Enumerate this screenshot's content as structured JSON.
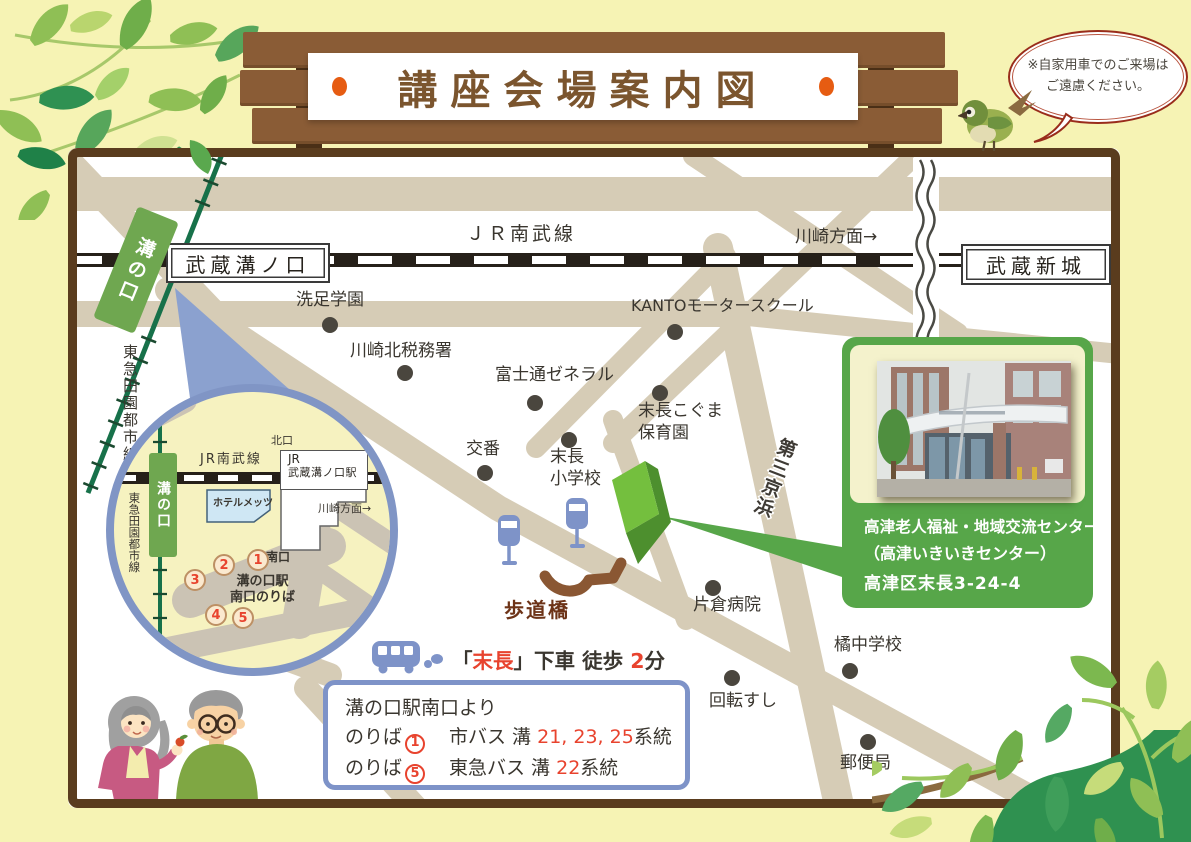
{
  "title": "講座会場案内図",
  "note": "※自家用車でのご来場は\nご遠慮ください。",
  "map": {
    "jr_line": "ＪＲ南武線",
    "direction": "川崎方面→",
    "station_left": "武蔵溝ノ口",
    "station_right": "武蔵新城",
    "tokyu_line": "東急田園都市線",
    "tokyu_station": "溝の口",
    "expressway": "第三京浜",
    "bridge": "歩道橋",
    "landmarks": [
      "洗足学園",
      "川崎北税務署",
      "富士通ゼネラル",
      "KANTOモータースクール",
      "末長こぐま\n保育園",
      "交番",
      "末長\n小学校",
      "片倉病院",
      "回転すし",
      "橘中学校",
      "郵便局"
    ]
  },
  "inset": {
    "jr_line": "JR南武線",
    "north_exit": "北口",
    "station_line1": "JR",
    "station_line2": "武蔵溝ノ口駅",
    "hotel": "ホテルメッツ",
    "direction": "川崎方面→",
    "south_exit": "南口",
    "stops_label": "溝の口駅\n南口のりば",
    "stops": [
      "1",
      "2",
      "3",
      "4",
      "5"
    ]
  },
  "destination": {
    "name": "高津老人福祉・地域交流センター",
    "sub_name": "（高津いきいきセンター）",
    "address": "高津区末長3-24-4"
  },
  "bus_stop": {
    "open": "「",
    "name": "末長",
    "after": "」下車 徒歩 ",
    "minutes": "2",
    "unit": "分"
  },
  "routes": {
    "heading": "溝の口駅南口より",
    "rows": [
      {
        "label": "のりば",
        "no": "1",
        "line": "市バス 溝 ",
        "numbers": "21, 23, 25",
        "suffix": "系統"
      },
      {
        "label": "のりば",
        "no": "5",
        "line": "東急バス 溝 ",
        "numbers": "22",
        "suffix": "系統"
      }
    ]
  },
  "colors": {
    "background": "#f6f3b4",
    "wood": "#8a5c36",
    "frame": "#5a3c1e",
    "title": "#7b552e",
    "accent_orange": "#e65c12",
    "accent_red": "#e8432e",
    "road": "#d6ccb6",
    "inset_road": "#cbc3b4",
    "rail_green": "#17714a",
    "station_green": "#6fa750",
    "inset_blue": "#8095c5",
    "bus_blue": "#7e93c8",
    "card_green": "#57a649",
    "bridge_brown": "#8a5733"
  }
}
